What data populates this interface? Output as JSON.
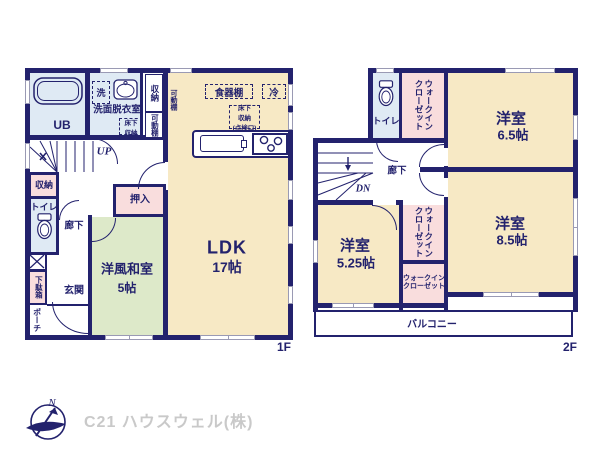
{
  "doc": {
    "type": "floor-plan",
    "floors": [
      "1F",
      "2F"
    ]
  },
  "colors": {
    "wall": "#23226d",
    "room_cream": "#f7e9c5",
    "tatami_green": "#dde9c9",
    "closet_pink": "#f9dddd",
    "wet_blue": "#dfeaf4",
    "company_gray": "#c9c9c9"
  },
  "f1": {
    "floor_tag": "1F",
    "ldk_name": "LDK",
    "ldk_size": "17帖",
    "washitsu_name": "洋風和室",
    "washitsu_size": "5帖",
    "ub": "UB",
    "senmen": "洗面脱衣室",
    "sen": "洗",
    "yukashita_l1": "床下",
    "yukashita_l2": "収納",
    "shuno_top": "収納",
    "kadodana_note": "可動棚",
    "kadodana_box": "可動棚",
    "shokkidana": "食器棚",
    "rei": "冷",
    "tenken_l1": "床下",
    "tenken_l2": "収納",
    "tenken_l3": "(点検口)",
    "up": "UP",
    "shuno_hall": "収納",
    "toilet": "トイレ",
    "rouka": "廊下",
    "oshiire": "押入",
    "getabako": "下駄箱",
    "genkan": "玄関",
    "porch": "ポーチ"
  },
  "f2": {
    "floor_tag": "2F",
    "toilet": "トイレ",
    "wic1_l1": "ウォークイン",
    "wic1_l2": "クローゼット",
    "room65_name": "洋室",
    "room65_size": "6.5帖",
    "rouka": "廊下",
    "dn": "DN",
    "room525_name": "洋室",
    "room525_size": "5.25帖",
    "wic2_l1": "ウォークイン",
    "wic2_l2": "クローゼット",
    "wic3_l1": "ウォークイン",
    "wic3_l2": "クローゼット",
    "room85_name": "洋室",
    "room85_size": "8.5帖",
    "balcony": "バルコニー"
  },
  "footer": {
    "compass_n": "N",
    "company": "C21 ハウスウェル(株)"
  }
}
